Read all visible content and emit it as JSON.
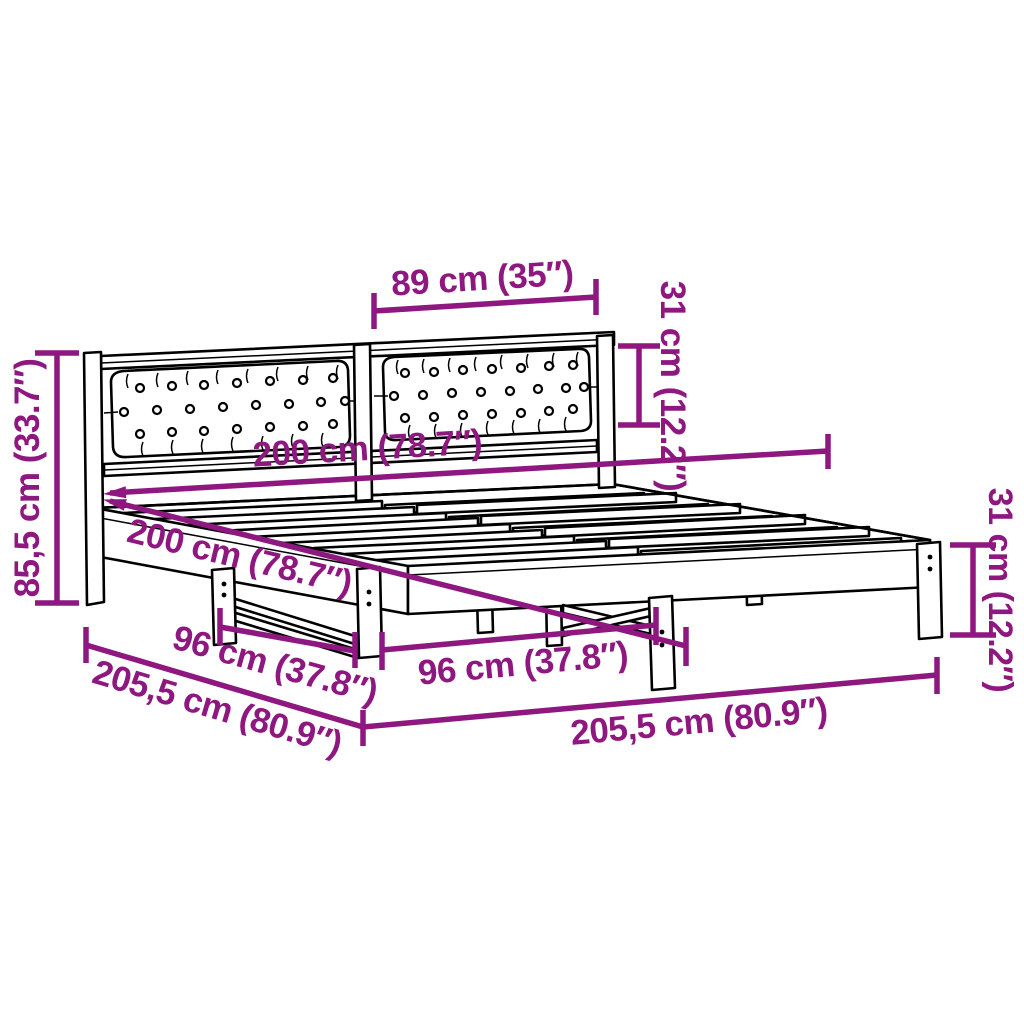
{
  "image": {
    "type": "product dimension diagram",
    "subject": "bed frame with tufted cushion headboard and slatted base",
    "style": "black outline drawing with magenta dimension annotations",
    "background_color": "#FFFFFF",
    "line_color": "#000000",
    "accent_color": "#8E1780"
  },
  "dimensions": {
    "headboard_panel_width": "89 cm (35″)",
    "headboard_cushion_height": "31 cm (12.2″)",
    "headboard_total_height": "85,5 cm (33.7″)",
    "mattress_width": "200 cm (78.7″)",
    "mattress_length": "200 cm (78.7″)",
    "leg_spacing_side": "96 cm (37.8″)",
    "leg_spacing_front": "96 cm (37.8″)",
    "frame_length_side": "205,5 cm (80.9″)",
    "frame_length_front": "205,5 cm (80.9″)",
    "frame_height": "31 cm (12.2″)"
  }
}
